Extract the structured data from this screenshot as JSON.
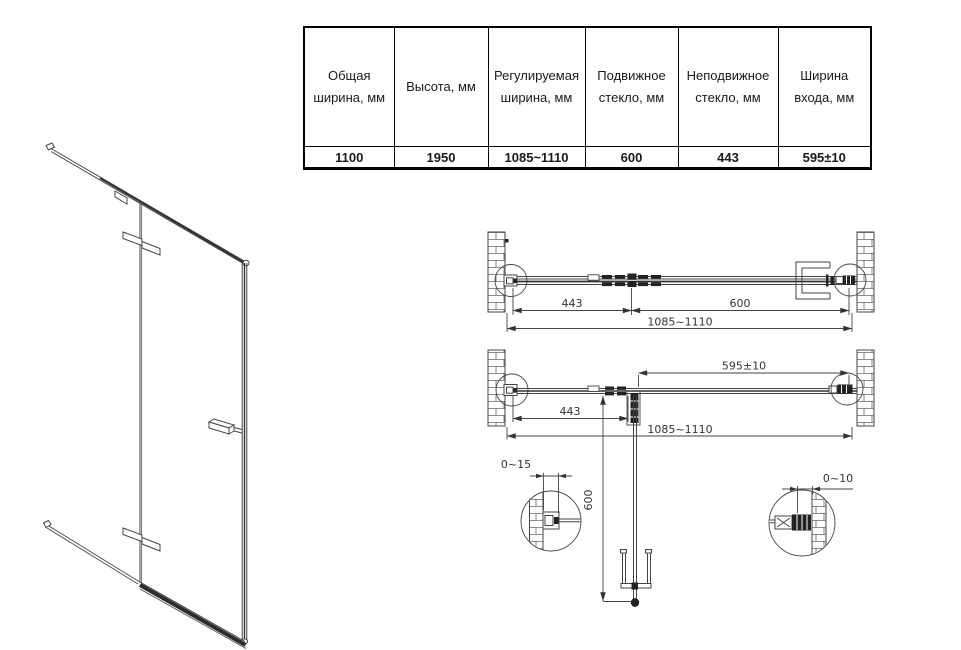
{
  "spec_table": {
    "cols": [
      {
        "header": "Общая ширина, мм",
        "value": "1100"
      },
      {
        "header": "Высота, мм",
        "value": "1950"
      },
      {
        "header": "Регулируемая ширина, мм",
        "value": "1085~1110"
      },
      {
        "header": "Подвижное стекло, мм",
        "value": "600"
      },
      {
        "header": "Неподвижное стекло, мм",
        "value": "443"
      },
      {
        "header": "Ширина входа, мм",
        "value": "595±10"
      }
    ]
  },
  "top_view_closed": {
    "fixed_glass": "443",
    "door_glass": "600",
    "total_width": "1085~1110"
  },
  "top_view_open": {
    "entry_width": "595±10",
    "fixed_glass": "443",
    "total_width": "1085~1110",
    "door_depth": "600"
  },
  "details": {
    "left_profile_adjust": "0~15",
    "right_profile_adjust": "0~10"
  },
  "colors": {
    "line": "#444444",
    "hardware": "#222222",
    "dim_text": "#333333",
    "table_text": "#1a1a1a",
    "background": "#ffffff"
  }
}
